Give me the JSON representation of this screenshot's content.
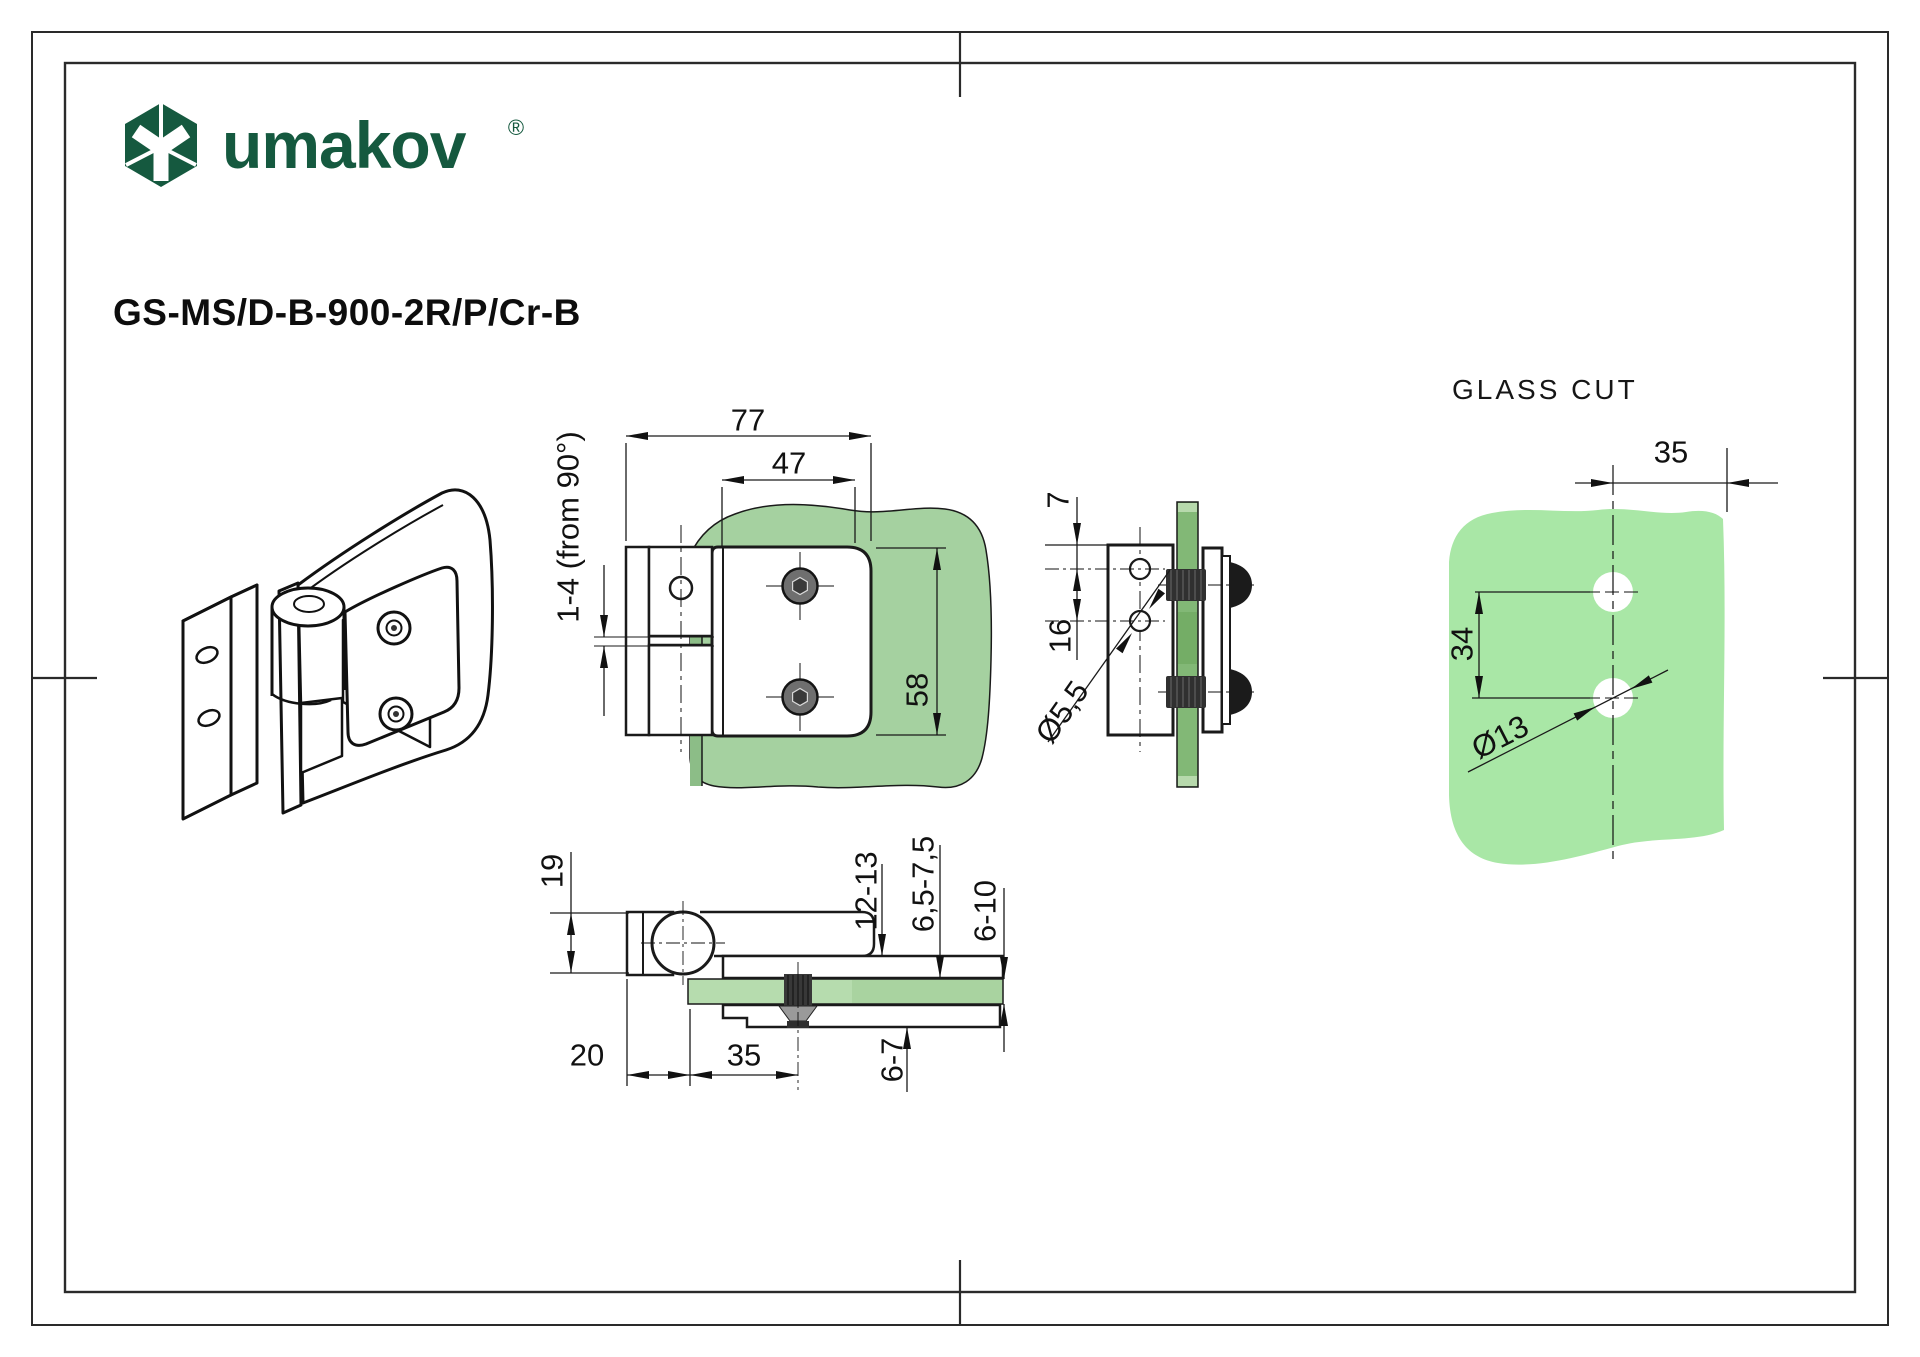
{
  "brand": {
    "name": "umakov",
    "registered_mark": "®"
  },
  "part_number": "GS-MS/D-B-900-2R/P/Cr-B",
  "glass_cut": {
    "title": "GLASS CUT",
    "edge_distance": "35",
    "hole_spacing": "34",
    "hole_diameter": "Ø13"
  },
  "front_view": {
    "width_total": "77",
    "width_inner": "47",
    "height": "58",
    "gap_adjust": "1-4 (from 90°)"
  },
  "side_view": {
    "edge_to_hole": "7",
    "hole_spacing": "16",
    "hole_diameter": "Ø5,5"
  },
  "top_view": {
    "knuckle_height": "19",
    "pivot_offset": "20",
    "hole_distance": "35",
    "clamp_thickness": "12-13",
    "plate_thickness": "6,5-7,5",
    "glass_thickness": "6-10",
    "lower_plate_thickness": "6-7"
  },
  "colors": {
    "brand_green": "#15593f",
    "glass_cut_green": "#a9e7a6",
    "glass_front_green": "#a5d1a0",
    "glass_side_green": "#82b876",
    "glass_top_green": "#b6dcae",
    "line_black": "#1a1a1a"
  }
}
